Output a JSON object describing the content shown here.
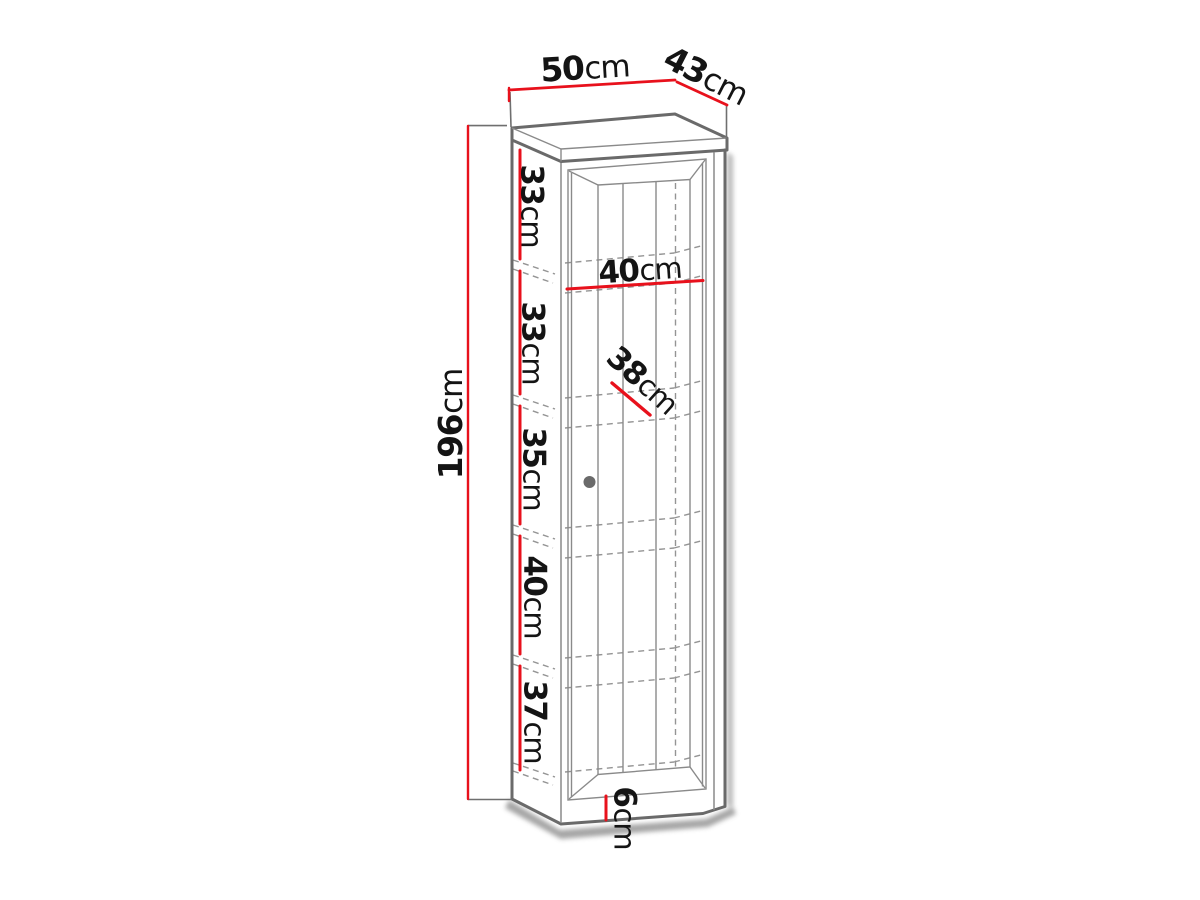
{
  "figure": {
    "kind": "furniture-dimension-diagram",
    "subject": "tall single-door cabinet, perspective line drawing with red dimension lines",
    "unit": "cm",
    "colors": {
      "dimension_line": "#e8111c",
      "drawing_line": "#6a6a6a",
      "hidden_line": "#949494",
      "text": "#141414",
      "background": "#ffffff",
      "knob": "#6a6a6a"
    },
    "dimensions": {
      "top_width": {
        "value": "50",
        "unit": "cm"
      },
      "top_depth": {
        "value": "43",
        "unit": "cm"
      },
      "total_height": {
        "value": "196",
        "unit": "cm"
      },
      "inner_width": {
        "value": "40",
        "unit": "cm"
      },
      "inner_depth": {
        "value": "38",
        "unit": "cm"
      },
      "plinth_height": {
        "value": "6",
        "unit": "cm"
      },
      "section_heights": [
        {
          "value": "33",
          "unit": "cm"
        },
        {
          "value": "33",
          "unit": "cm"
        },
        {
          "value": "35",
          "unit": "cm"
        },
        {
          "value": "40",
          "unit": "cm"
        },
        {
          "value": "37",
          "unit": "cm"
        }
      ]
    }
  }
}
